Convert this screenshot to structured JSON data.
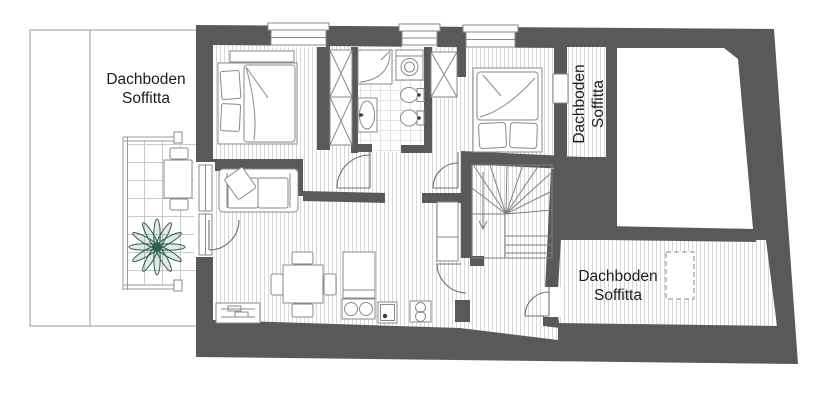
{
  "labels": {
    "attic_left": {
      "line1": "Dachboden",
      "line2": "Soffitta"
    },
    "attic_right_top": {
      "line1": "Dachboden",
      "line2": "Soffitta"
    },
    "attic_right_bottom": {
      "line1": "Dachboden",
      "line2": "Soffitta"
    }
  },
  "colors": {
    "wall": "#595959",
    "floor-line": "#d7d7d7",
    "tile-line": "#c9c9c9",
    "bath-line": "#e3e3e3",
    "outline": "#9a9a9a",
    "furniture": "#8a8a8a",
    "door": "#6f6f6f",
    "stair": "#7e7e7e",
    "plant": "#2e5f4d",
    "text": "#1c1c1c",
    "background": "#ffffff",
    "fixture-dot": "#3a3a3a"
  },
  "symbols": [
    "double-bed",
    "wardrobe-x",
    "corner-shower",
    "washing-machine",
    "bidet",
    "toilet",
    "washbasin",
    "sofa",
    "dining-table-with-chairs",
    "sideboard",
    "kitchen-sink",
    "oven",
    "hob-two-burners",
    "tall-cupboard",
    "winder-staircase",
    "stair-direction-arrow",
    "balcony-railing",
    "balcony-table-with-chairs",
    "potted-plant",
    "window",
    "door-swing",
    "chimney-dashed"
  ]
}
